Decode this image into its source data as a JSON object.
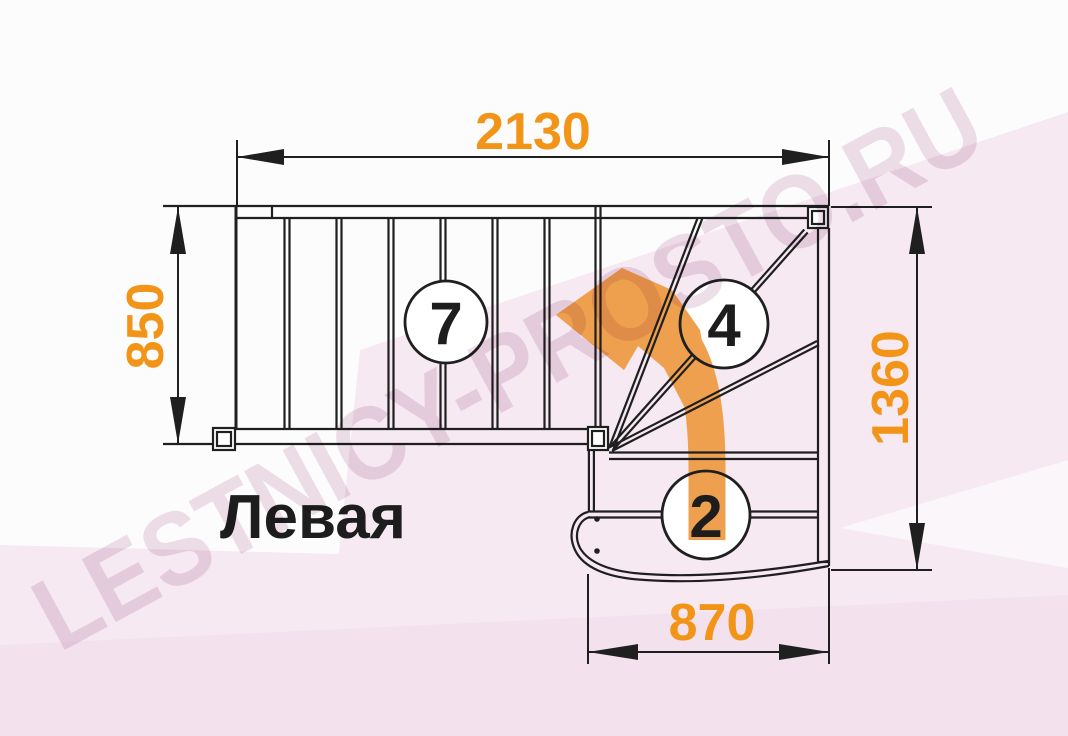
{
  "plan": {
    "label": "Левая",
    "watermark": "LESTNICY-PROSTO.RU",
    "dims": {
      "top": "2130",
      "left": "850",
      "right": "1360",
      "bottom": "870"
    },
    "steps": {
      "upper_flight": "7",
      "winder": "4",
      "lower_flight": "2"
    },
    "colors": {
      "dimension_text": "#f29418",
      "direction_arrow": "#efa04f",
      "drawing_lines": "#1f1f1f",
      "label_text": "#1d1d1d",
      "watermark": "#eddfe8"
    }
  }
}
